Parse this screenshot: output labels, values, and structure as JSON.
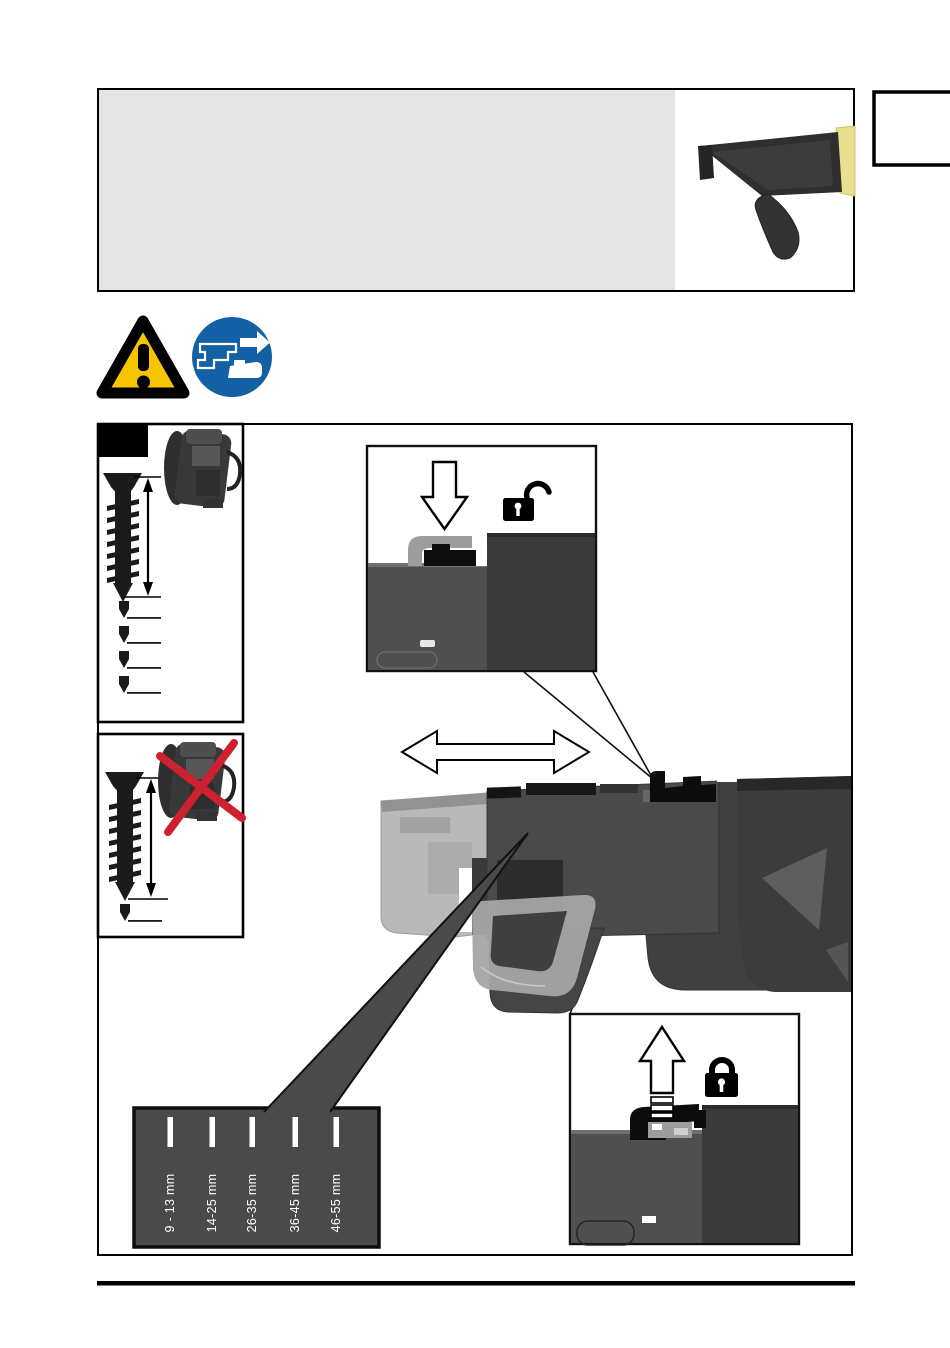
{
  "depth_panel": {
    "ranges": [
      "9 - 13 mm",
      "14-25 mm",
      "26-35 mm",
      "36-45 mm",
      "46-55 mm"
    ]
  },
  "icons": {
    "warning": "warning-triangle-icon",
    "unplug": "disconnect-plug-icon",
    "unlock": "open-padlock-icon",
    "lock": "closed-padlock-icon",
    "slide_down": "arrow-down-icon",
    "slide_up": "arrow-up-icon",
    "adjust": "double-horizontal-arrow-icon",
    "wrong_screw": "red-cross-icon"
  },
  "colors": {
    "warning_yellow": "#f6c500",
    "mandatory_blue": "#1460a5",
    "prohibition_red": "#cf2030",
    "panel_gray": "#4a4a4a",
    "header_gray": "#e5e5e5",
    "photo_dark": "#3a3a3a",
    "photo_mid": "#4f4f4f",
    "ghost_gray": "#b4b4b4"
  }
}
